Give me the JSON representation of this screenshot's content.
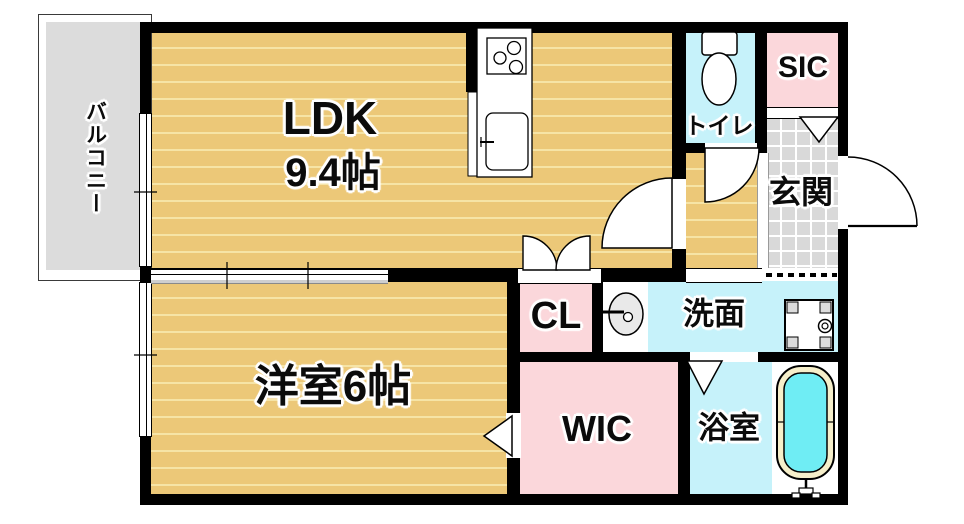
{
  "plan_title": "1LDK floor plan",
  "rooms": {
    "balcony": {
      "label": "バルコニー"
    },
    "ldk": {
      "label": "LDK",
      "size": "9.4帖"
    },
    "toilet": {
      "label": "トイレ"
    },
    "sic": {
      "label": "SIC"
    },
    "genkan": {
      "label": "玄関"
    },
    "cl": {
      "label": "CL"
    },
    "senmen": {
      "label": "洗面"
    },
    "western_room": {
      "label": "洋室6帖"
    },
    "wic": {
      "label": "WIC"
    },
    "bathroom": {
      "label": "浴室"
    }
  },
  "colors": {
    "wood": "#ecc878",
    "wood_stripe": "#f6e4a6",
    "water_rooms": "#c6f2fa",
    "storage_rooms": "#fbd7db",
    "balcony": "#dcdcdc",
    "tile": "#d9d9d9",
    "bath_water": "#6fedf4",
    "tub_rim": "#f6efca",
    "basin": "#e9e9e9",
    "wall": "#000000"
  },
  "fixtures": [
    "toilet-icon",
    "stove-icon",
    "kitchen-sink-icon",
    "washbasin-icon",
    "washing-machine-pan-icon",
    "bathtub-icon",
    "entrance-door-arc",
    "ldk-door-arc",
    "toilet-door-arc",
    "cl-double-doors",
    "bath-door-triangle",
    "wic-door-triangle",
    "sic-door-triangle"
  ]
}
